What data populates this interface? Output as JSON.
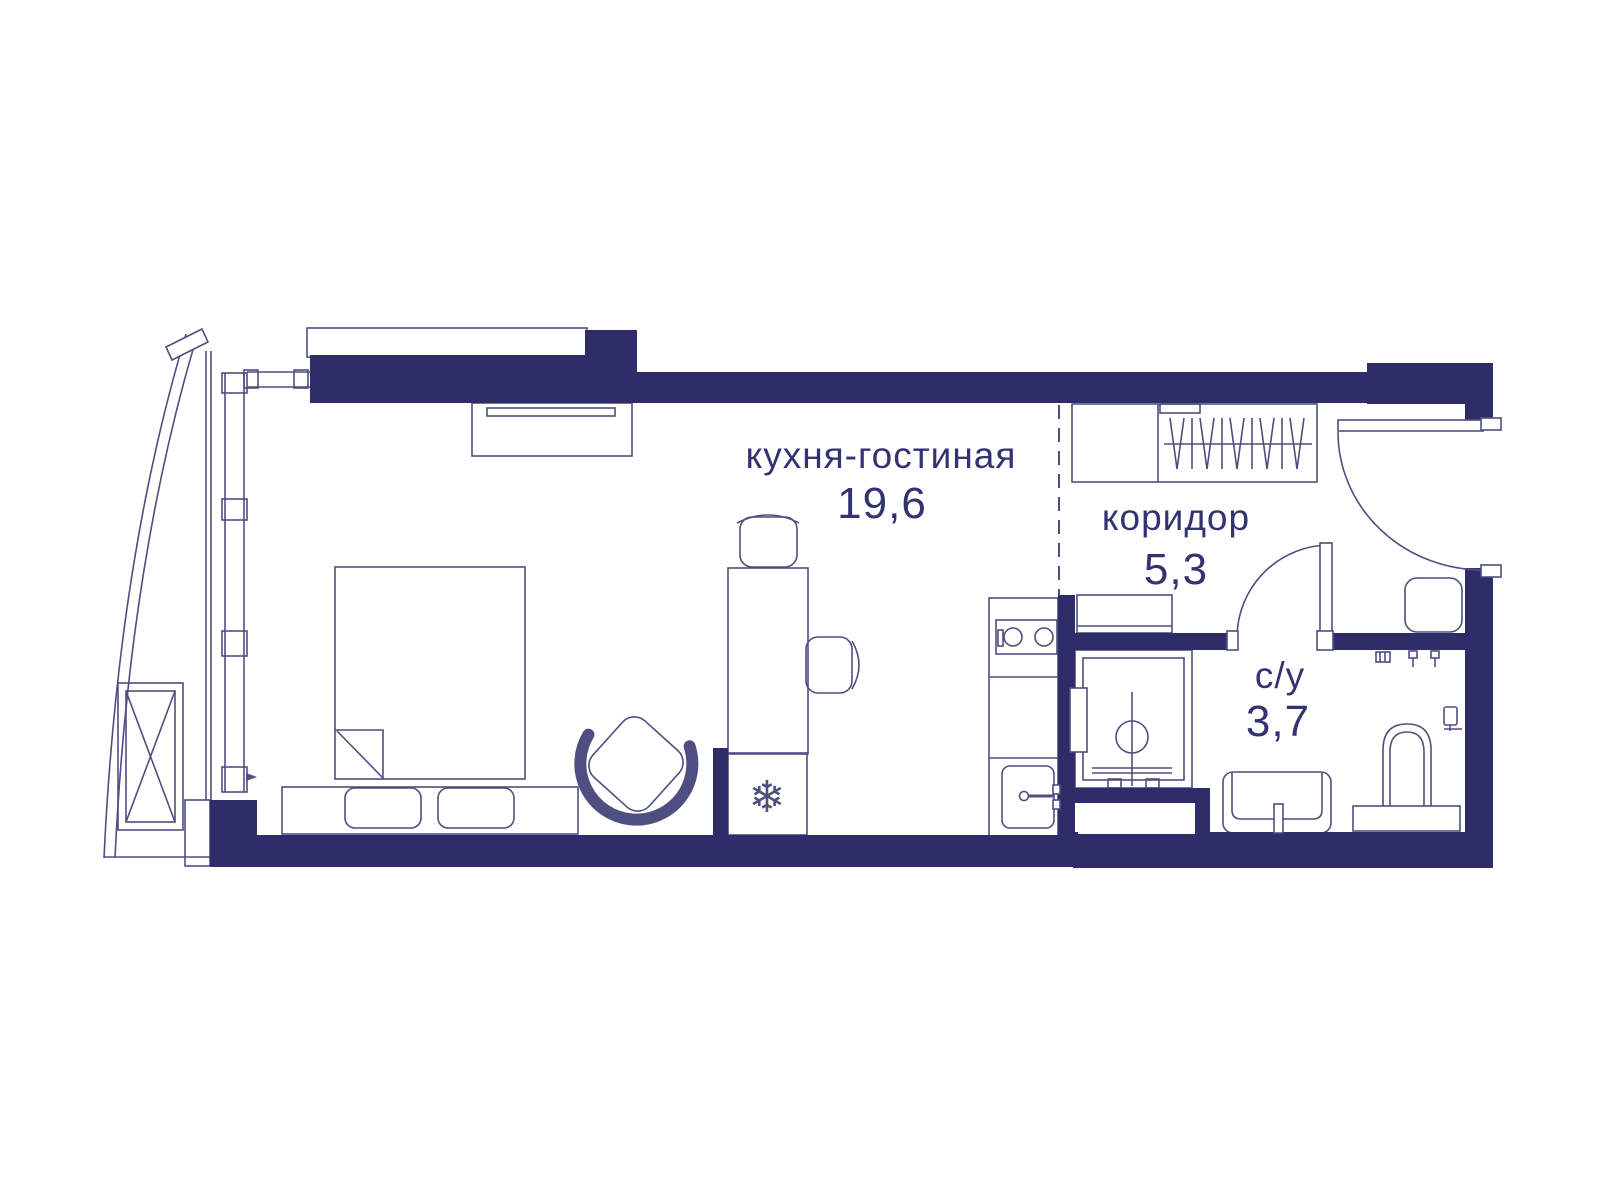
{
  "rooms": [
    {
      "name": "кухня-гостиная",
      "area": "19,6"
    },
    {
      "name": "коридор",
      "area": "5,3"
    },
    {
      "name": "с/у",
      "area": "3,7"
    }
  ],
  "icons": {
    "freezer": "❄"
  },
  "colors": {
    "wall": "#2e2d6a",
    "line": "#4e4e80",
    "text": "#343371",
    "bg": "#ffffff"
  }
}
